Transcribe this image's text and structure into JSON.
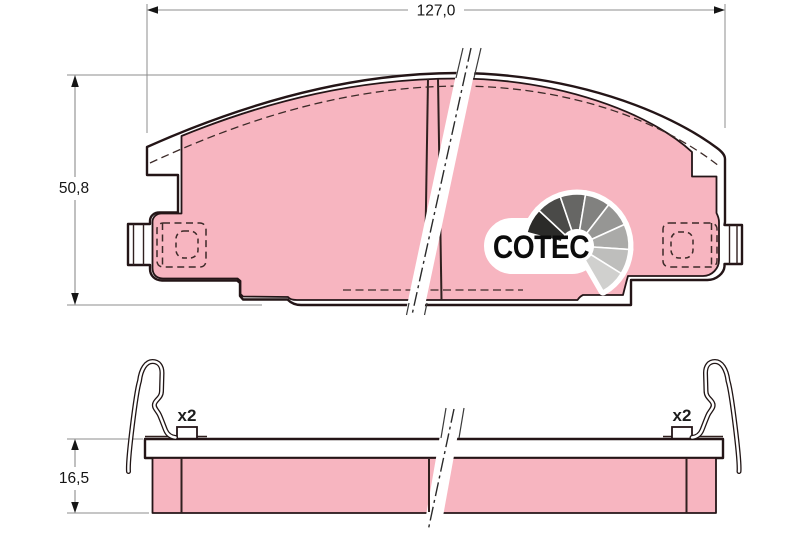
{
  "dimensions": {
    "width_label": "127,0",
    "height_label": "50,8",
    "thickness_label": "16,5"
  },
  "annotations": {
    "clip_count_left": "x2",
    "clip_count_right": "x2"
  },
  "logo": {
    "text": "COTEC",
    "fan_shades": [
      "#2b2b29",
      "#4a4a48",
      "#666664",
      "#81817f",
      "#969694",
      "#aaaaa8",
      "#bebebc",
      "#d0d0ce"
    ]
  },
  "colors": {
    "friction_pink": "#f7b5c0",
    "outline_dark": "#241517",
    "thin_line": "#30201f",
    "dashed_line": "#3c2a28",
    "dimension_gray": "#8c8c8c",
    "dimension_text": "#151515"
  }
}
